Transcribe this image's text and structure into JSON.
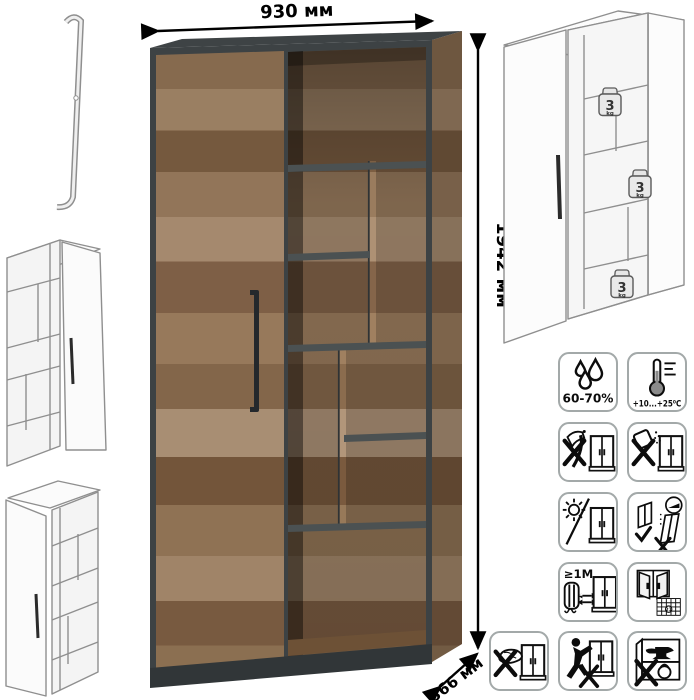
{
  "dimensions": {
    "width": "930 мм",
    "height": "1942 мм",
    "depth": "366 мм"
  },
  "shelf_capacity": {
    "value": "3",
    "unit": "kg"
  },
  "care": {
    "humidity": "60-70%",
    "temperature": "+10...+25⁰C",
    "min_distance": "≥1М",
    "calendar_day": "21"
  },
  "colors": {
    "wood": "#9b7d5f",
    "wood_dark": "#7c5e42",
    "graphite": "#42474a",
    "drawing_line": "#8f8f8f",
    "icon_border": "#a3a9a9",
    "dimension_text": "#000000"
  }
}
